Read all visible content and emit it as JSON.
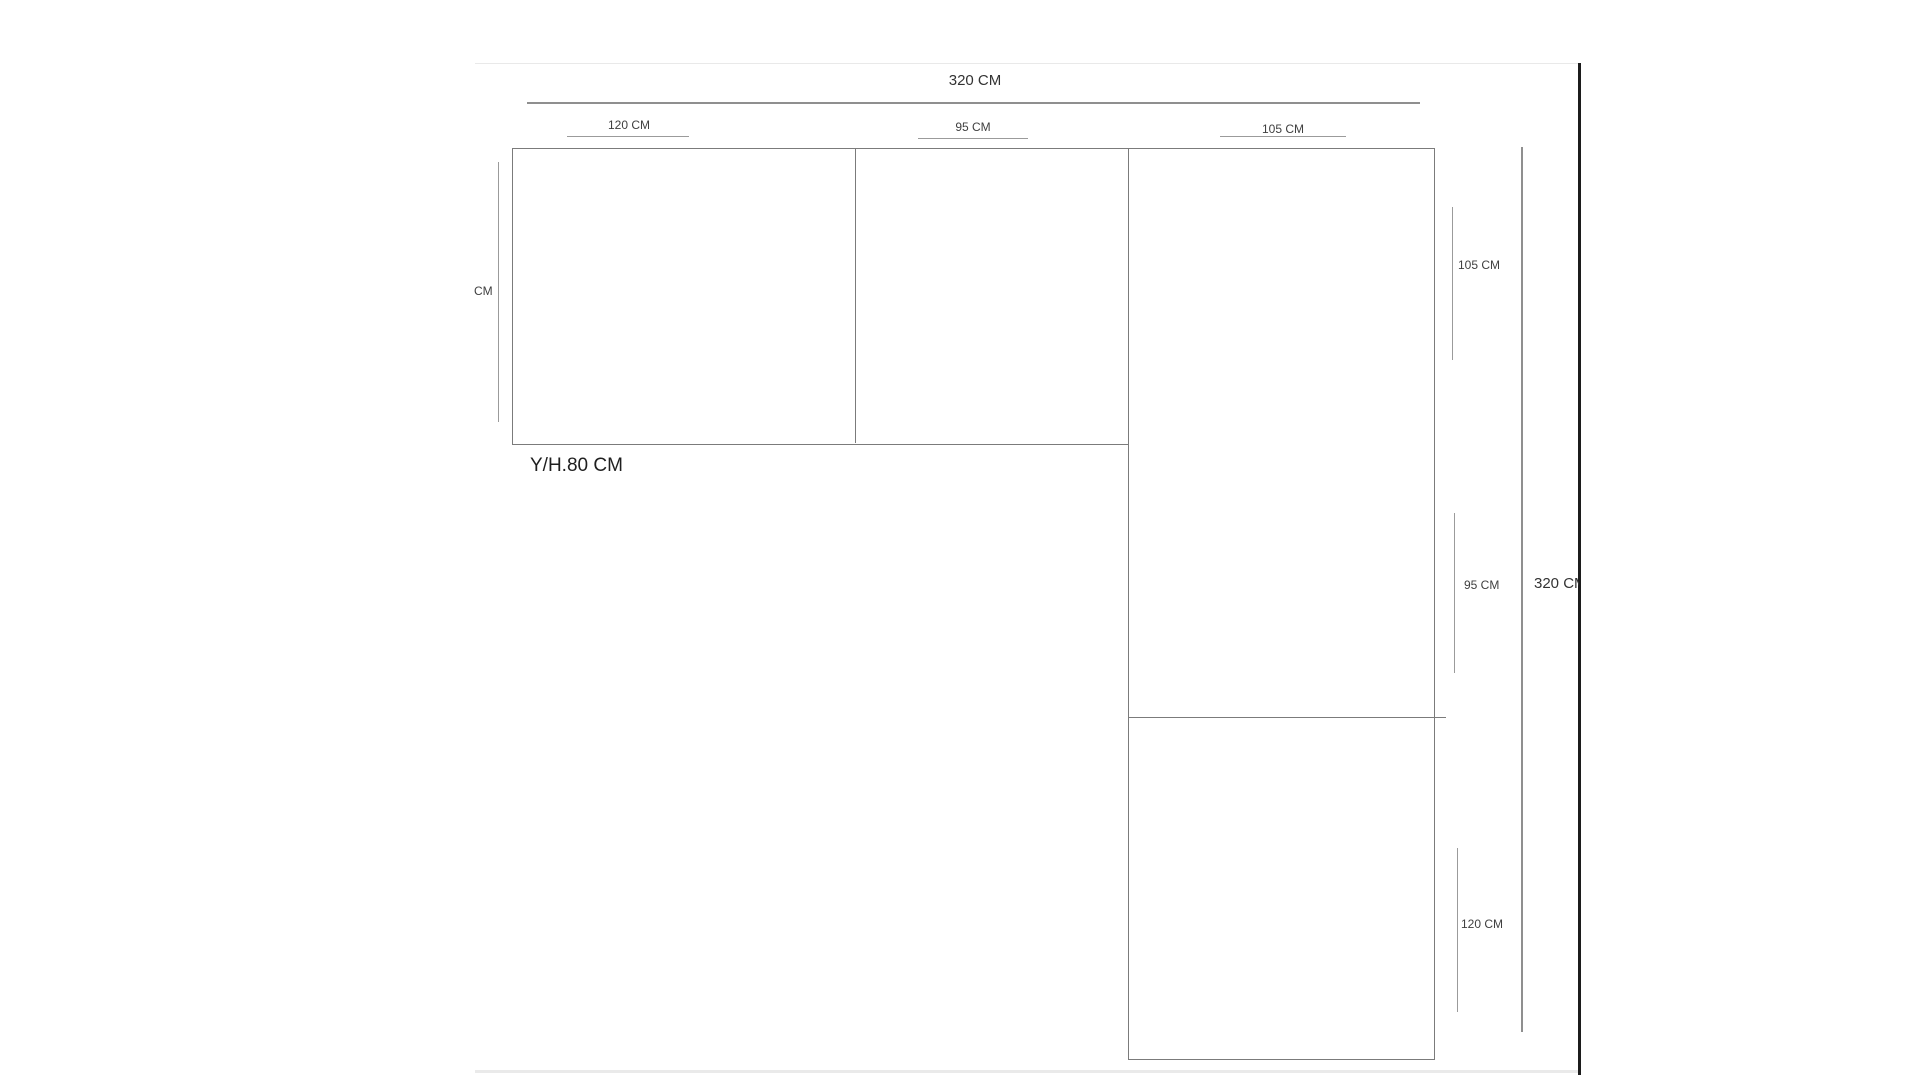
{
  "diagram": {
    "top_total_label": "320 CM",
    "top_segment_labels": [
      "120 CM",
      "95 CM",
      "105 CM"
    ],
    "left_clipped_label": "CM",
    "height_note_label": "Y/H.80 CM",
    "right_segment_labels": [
      "105 CM",
      "95 CM",
      "120 CM"
    ],
    "right_total_label": "320 CM",
    "colors": {
      "outline": "#7b7b7b",
      "dimension_line": "#9b9b9b",
      "label_text": "#3f3f3f",
      "page_edge": "#1c1c1c"
    }
  }
}
